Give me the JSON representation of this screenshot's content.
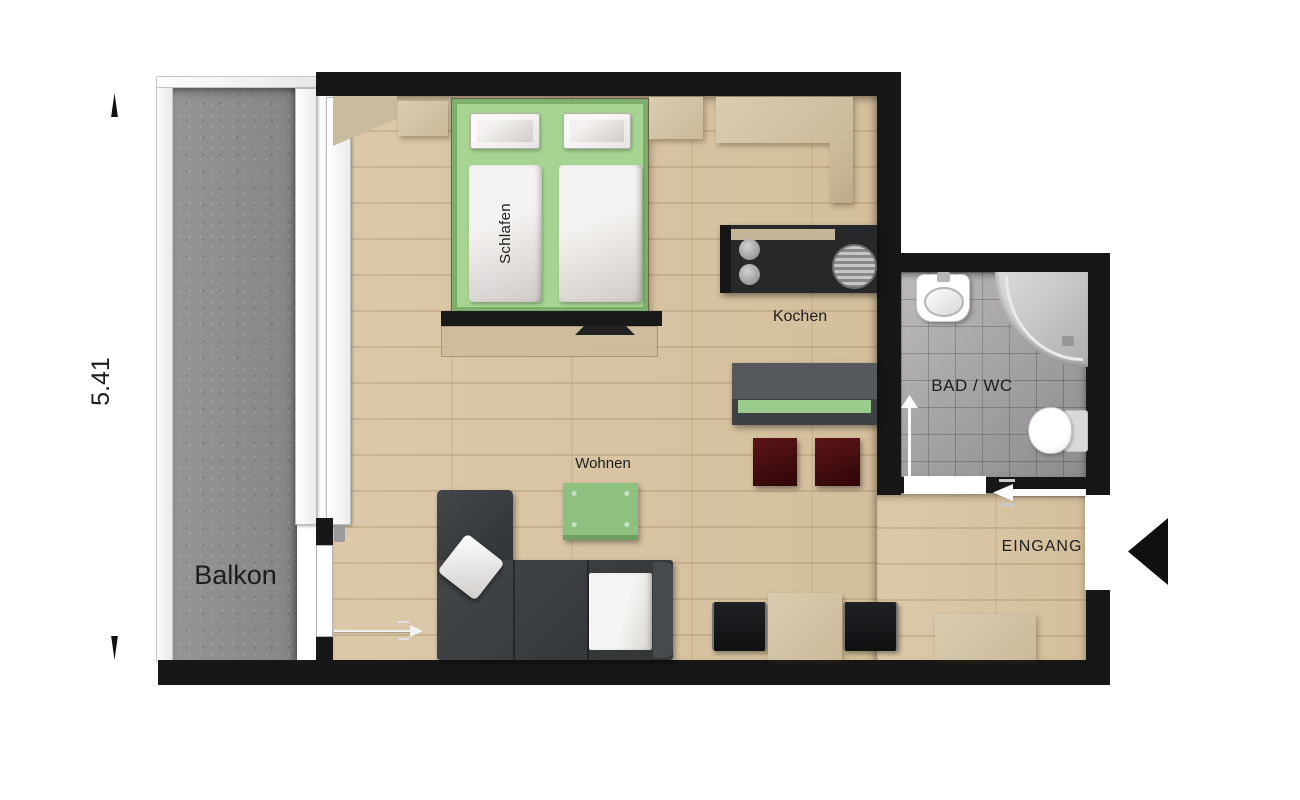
{
  "plan": {
    "labels": {
      "balcony": "Balkon",
      "dimension_left": "5.41",
      "sleeping": "Schlafen",
      "cooking": "Kochen",
      "living": "Wohnen",
      "bathroom": "BAD / WC",
      "entrance": "EINGANG"
    },
    "palette": {
      "wall": "#171717",
      "wood_floor": "#d8c4a3",
      "balcony_concrete": "#8d8d8d",
      "bathroom_tile": "#a4a1a4",
      "bed_green": "#a7d492",
      "coffee_table_green": "#8ec180",
      "bench_green": "#9ccb8e",
      "sofa_charcoal": "#3b3e40",
      "stool_maroon": "#4a0f0f",
      "kitchen_counter": "#26282a",
      "furniture_wood": "#d4c6a9",
      "door_white": "#ffffff"
    }
  }
}
